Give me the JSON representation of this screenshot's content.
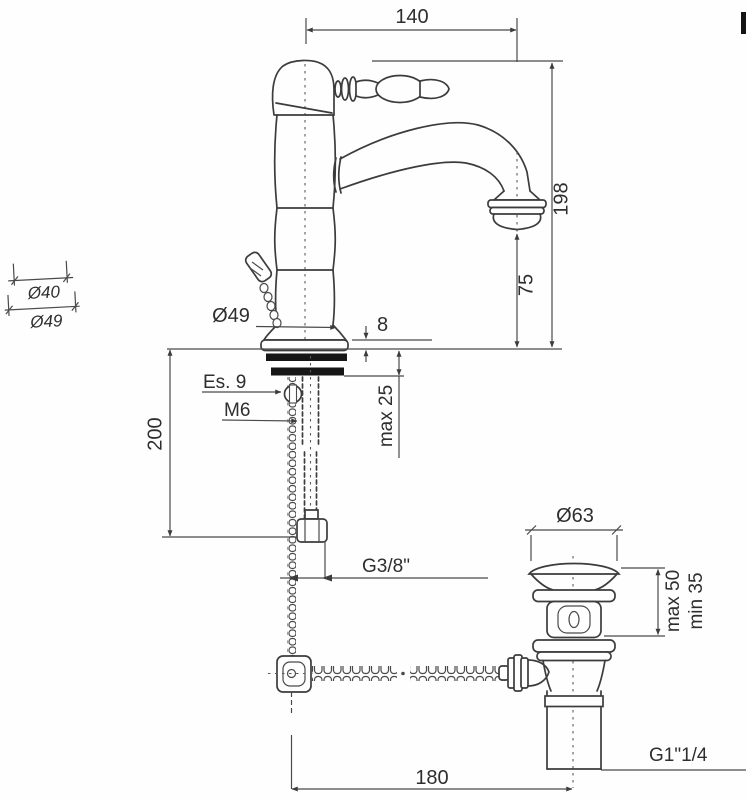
{
  "drawing": {
    "title": "Basin mixer tap with pop-up waste — dimensional technical drawing",
    "dims": {
      "spout_reach": "140",
      "total_height": "198",
      "spout_outlet_height": "75",
      "escutcheon_diameter": "Ø49",
      "escutcheon_height": "8",
      "hex_size": "Es. 9",
      "stud_thread": "M6",
      "max_mounting_thickness": "max 25",
      "hose_length": "200",
      "hose_thread": "G3/8\"",
      "waste_flange_diameter": "Ø63",
      "waste_basin_max": "max 50",
      "waste_basin_min": "min 35",
      "waste_outlet_thread": "G1\"1/4",
      "horizontal_span": "180"
    },
    "handle_detail": {
      "inner_diameter": "Ø40",
      "outer_diameter": "Ø49"
    },
    "colors": {
      "line": "#3c3c3c",
      "text": "#2e2e2e",
      "gasket_black": "#161616",
      "background": "#ffffff"
    }
  }
}
